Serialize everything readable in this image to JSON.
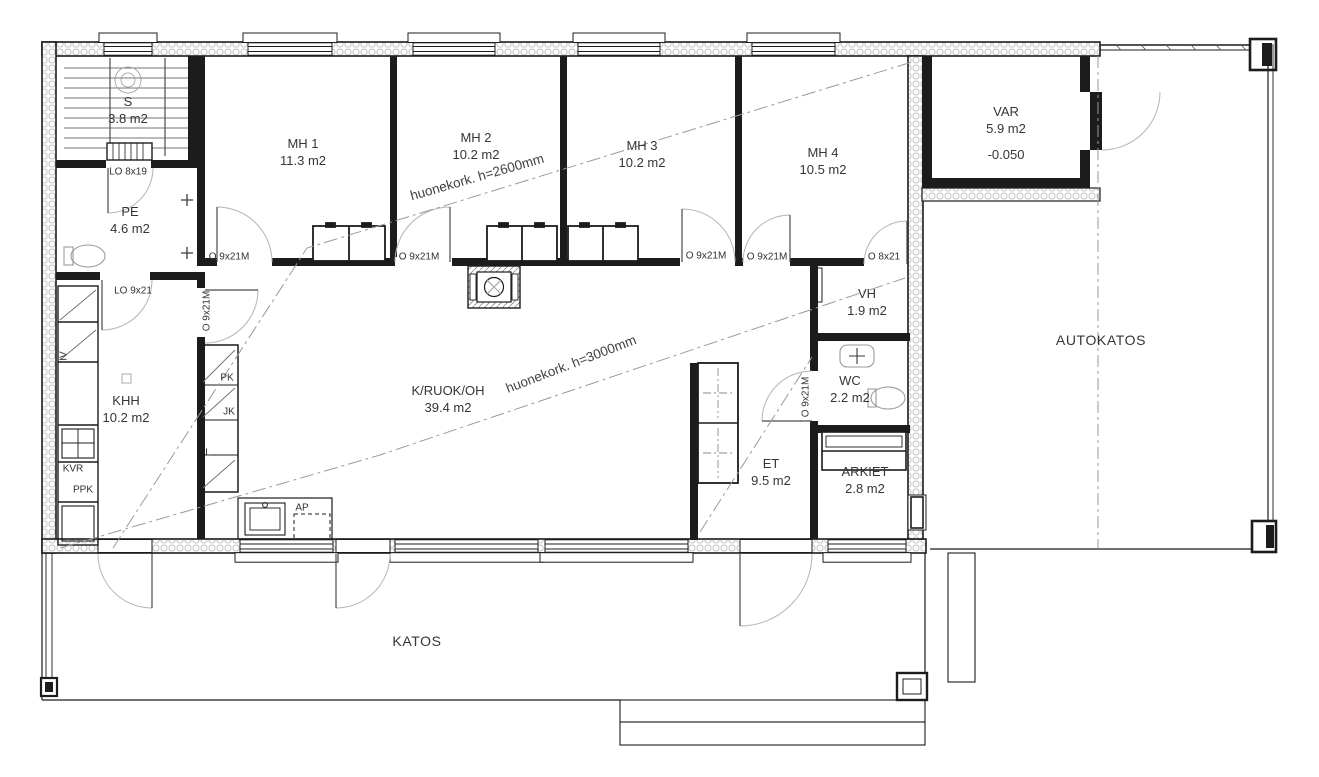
{
  "plan": {
    "rooms": [
      {
        "id": "sauna",
        "name": "S",
        "area": "3.8 m2",
        "x": 128,
        "y": 110
      },
      {
        "id": "pe",
        "name": "PE",
        "area": "4.6 m2",
        "x": 130,
        "y": 220
      },
      {
        "id": "mh1",
        "name": "MH 1",
        "area": "11.3 m2",
        "x": 303,
        "y": 152
      },
      {
        "id": "mh2",
        "name": "MH 2",
        "area": "10.2 m2",
        "x": 476,
        "y": 146
      },
      {
        "id": "mh3",
        "name": "MH 3",
        "area": "10.2 m2",
        "x": 642,
        "y": 154
      },
      {
        "id": "mh4",
        "name": "MH 4",
        "area": "10.5 m2",
        "x": 823,
        "y": 161
      },
      {
        "id": "var",
        "name": "VAR",
        "area": "5.9 m2",
        "level": "-0.050",
        "x": 1006,
        "y": 133
      },
      {
        "id": "khh",
        "name": "KHH",
        "area": "10.2 m2",
        "x": 126,
        "y": 409
      },
      {
        "id": "k-ruok-oh",
        "name": "K/RUOK/OH",
        "area": "39.4 m2",
        "x": 448,
        "y": 399
      },
      {
        "id": "vh",
        "name": "VH",
        "area": "1.9 m2",
        "x": 867,
        "y": 302
      },
      {
        "id": "wc",
        "name": "WC",
        "area": "2.2 m2",
        "x": 850,
        "y": 389
      },
      {
        "id": "et",
        "name": "ET",
        "area": "9.5 m2",
        "x": 771,
        "y": 472
      },
      {
        "id": "arkiet",
        "name": "ARKIET",
        "area": "2.8 m2",
        "x": 865,
        "y": 480
      }
    ],
    "zones": [
      {
        "id": "autokatos",
        "name": "AUTOKATOS",
        "x": 1101,
        "y": 340
      },
      {
        "id": "katos",
        "name": "KATOS",
        "x": 417,
        "y": 641
      }
    ],
    "annotations": [
      {
        "id": "height-2600",
        "text": "huonekork. h=2600mm",
        "x": 477,
        "y": 177,
        "rot": -16
      },
      {
        "id": "height-3000",
        "text": "huonekork. h=3000mm",
        "x": 571,
        "y": 364,
        "rot": -21
      }
    ],
    "door_labels": [
      {
        "text": "LO 8x19",
        "x": 128,
        "y": 172,
        "rot": 0
      },
      {
        "text": "LO 9x21",
        "x": 133,
        "y": 291,
        "rot": 0
      },
      {
        "text": "O 9x21M",
        "x": 229,
        "y": 257,
        "rot": 0
      },
      {
        "text": "O 9x21M",
        "x": 419,
        "y": 257,
        "rot": 0
      },
      {
        "text": "O 9x21M",
        "x": 706,
        "y": 256,
        "rot": 0
      },
      {
        "text": "O 9x21M",
        "x": 767,
        "y": 257,
        "rot": 0
      },
      {
        "text": "O 8x21",
        "x": 884,
        "y": 257,
        "rot": 0
      },
      {
        "text": "O 9x21M",
        "x": 207,
        "y": 311,
        "rot": -90
      },
      {
        "text": "O 9x21M",
        "x": 806,
        "y": 397,
        "rot": -90
      }
    ],
    "fixture_labels": [
      {
        "text": "IV",
        "x": 64,
        "y": 356,
        "rot": -90
      },
      {
        "text": "PK",
        "x": 227,
        "y": 378,
        "rot": 0
      },
      {
        "text": "JK",
        "x": 229,
        "y": 412,
        "rot": 0
      },
      {
        "text": "L",
        "x": 208,
        "y": 453,
        "rot": 0
      },
      {
        "text": "KVR",
        "x": 73,
        "y": 469,
        "rot": 0
      },
      {
        "text": "PPK",
        "x": 83,
        "y": 490,
        "rot": 0
      },
      {
        "text": "AP",
        "x": 302,
        "y": 508,
        "rot": 0
      }
    ],
    "colors": {
      "wall_line": "#1c1c1c",
      "label_text": "#3a3430",
      "door_arc": "#b4b4b4",
      "section_line": "#9a9a9a"
    }
  }
}
